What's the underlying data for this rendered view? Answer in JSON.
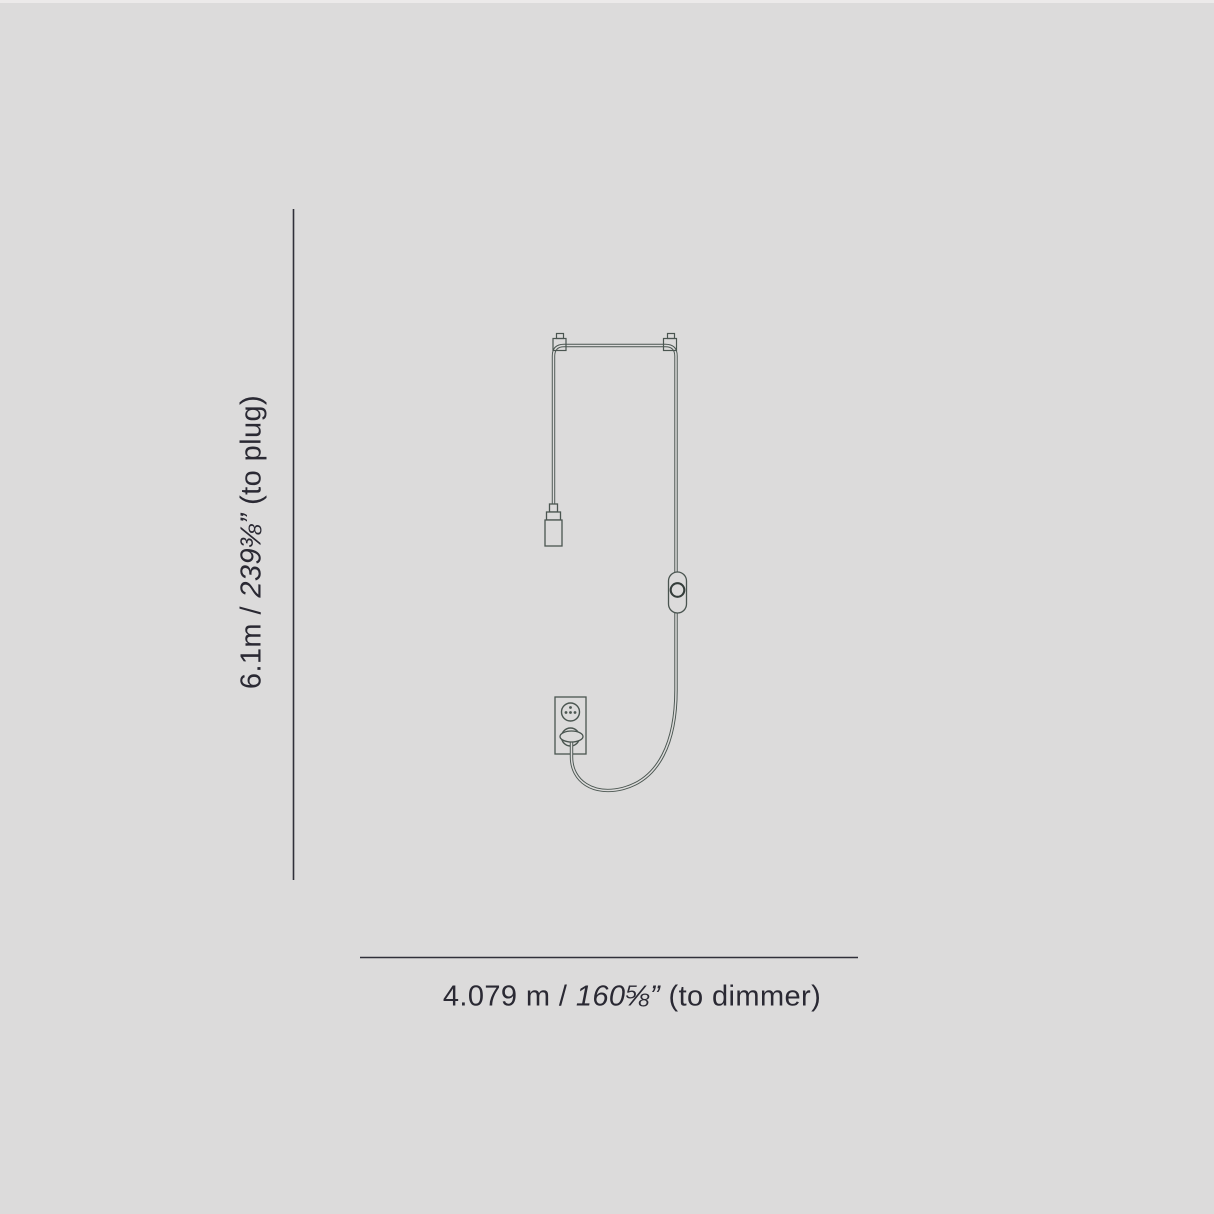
{
  "canvas": {
    "width": 1214,
    "height": 1214
  },
  "colors": {
    "background": "#dcdbdb",
    "line": "#4a5550",
    "line_dark": "#343d3a",
    "dimension_line": "#30303a",
    "text": "#2a2933"
  },
  "diagram": {
    "kind": "pendant-lamp-cord-dimension-drawing",
    "parts": [
      "ceiling-hook-left",
      "ceiling-hook-right",
      "cord",
      "lamp-socket",
      "dimmer-switch",
      "wall-outlet",
      "plug"
    ]
  },
  "labels": {
    "vertical": {
      "metric": "6.1m /",
      "imperial": "239⅜”",
      "suffix": "(to plug)"
    },
    "horizontal": {
      "metric": "4.079 m /",
      "imperial": "160⅝”",
      "suffix": "(to dimmer)"
    }
  }
}
